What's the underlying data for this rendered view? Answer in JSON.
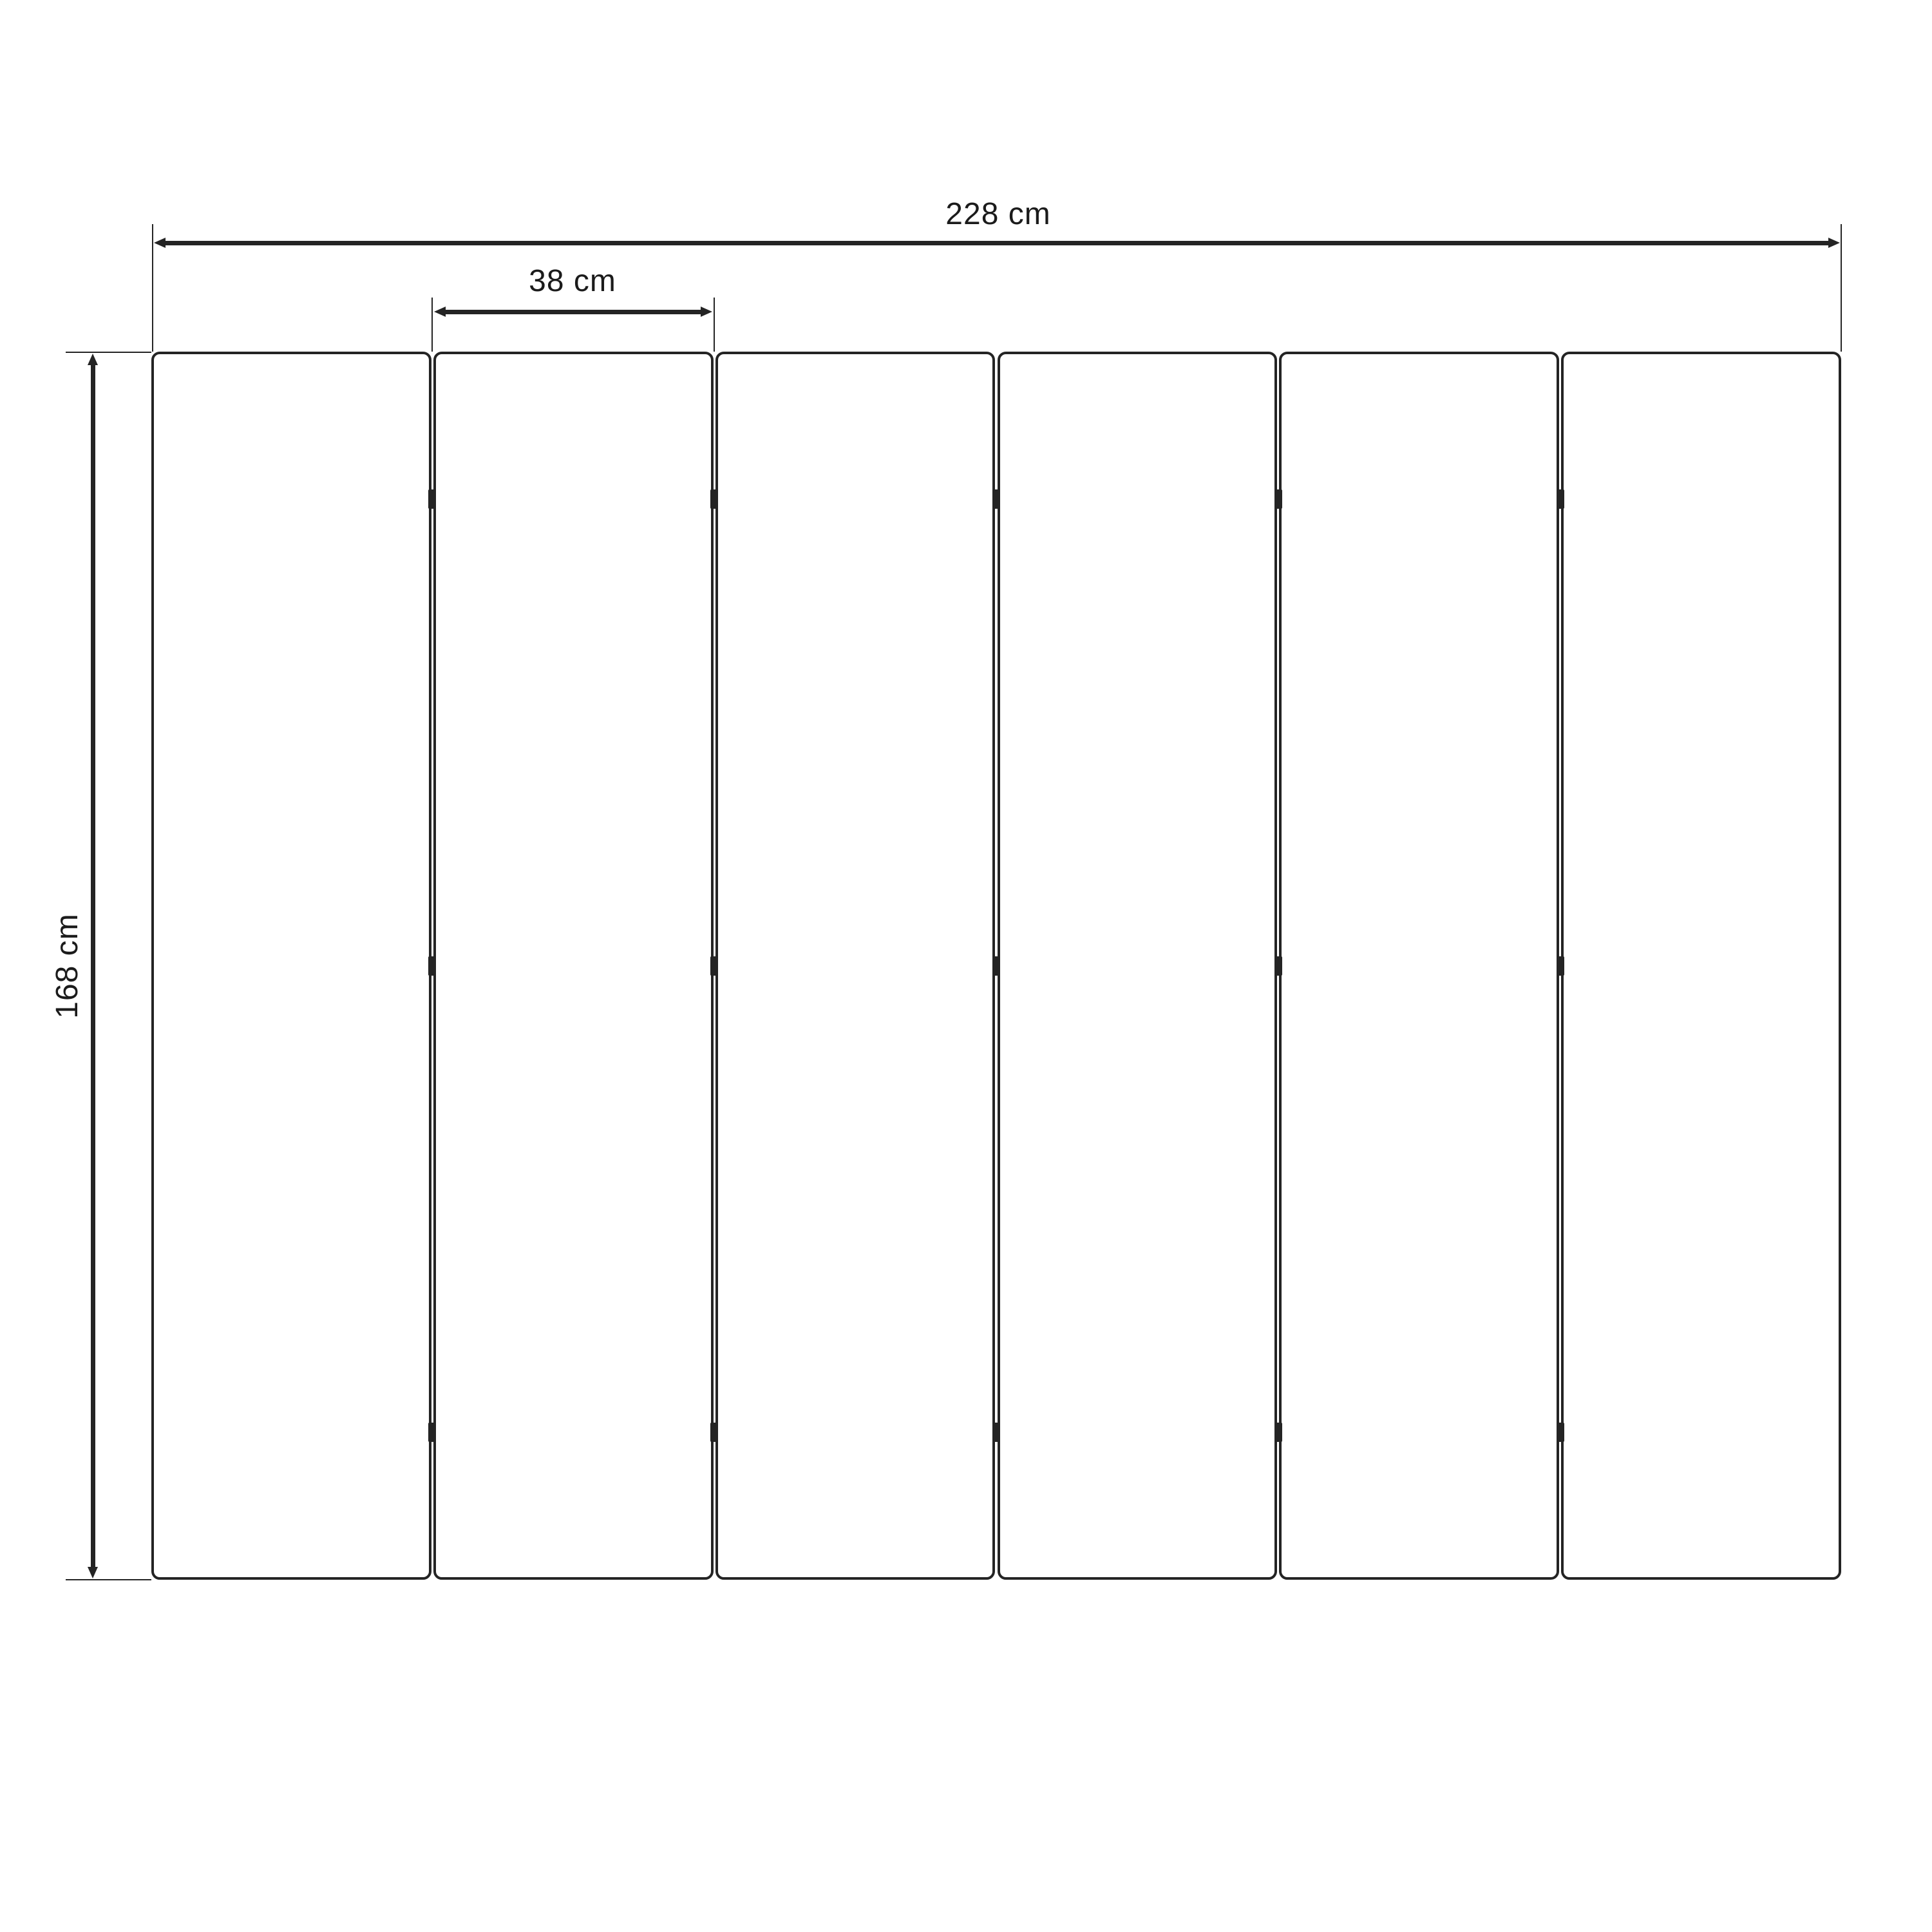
{
  "diagram": {
    "kind": "technical-dimension-drawing",
    "subject": "six-panel folding screen front view",
    "unit": "cm",
    "panels": {
      "count": 6,
      "gaps": 5,
      "connectors_per_gap": 3
    },
    "dimensions": {
      "total_width": {
        "value": 228,
        "label": "228 cm"
      },
      "single_panel_width": {
        "value": 38,
        "label": "38 cm"
      },
      "height": {
        "value": 168,
        "label": "168 cm"
      }
    },
    "colors": {
      "stroke": "#242424",
      "text": "#1b1b1b",
      "background": "#ffffff"
    }
  }
}
